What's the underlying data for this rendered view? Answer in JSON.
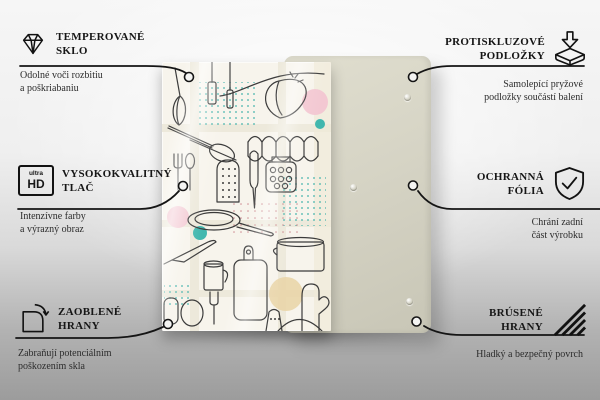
{
  "page": {
    "type": "product-feature-infographic",
    "language": "sk/cz"
  },
  "colors": {
    "background_top": "#f6f6f6",
    "background_bottom": "#9c9c9c",
    "line": "#151515",
    "back_panel": "#d6d4c5",
    "glass_background": "#f7f4ec",
    "art_stroke": "#3b3b3b",
    "art_pink": "#f3c8d2",
    "art_teal": "#49b5ae",
    "art_tan": "#e9d3a6"
  },
  "product": {
    "front_panel": "tempered glass panel printed with kitchen utensil line-art",
    "back_panel": "plain rear panel with round anti-slip pads",
    "visible_pads": 3
  },
  "callouts": {
    "left": [
      {
        "icon": "diamond-icon",
        "title": [
          "TEMPEROVANÉ",
          "SKLO"
        ],
        "subtitle": [
          "Odolné voči rozbitiu",
          "a poškriabaniu"
        ]
      },
      {
        "icon": "ultra-hd-icon",
        "icon_text": {
          "top": "ultra",
          "bottom": "HD"
        },
        "title": [
          "VYSOKOKVALITNÝ",
          "TLAČ"
        ],
        "subtitle": [
          "Intenzívne farby",
          "a výrazný obraz"
        ]
      },
      {
        "icon": "rounded-corner-icon",
        "title": [
          "ZAOBLENÉ",
          "HRANY"
        ],
        "subtitle": [
          "Zabraňují potenciálním",
          "poškozením skla"
        ]
      }
    ],
    "right": [
      {
        "icon": "anti-slip-pad-icon",
        "title": [
          "PROTISKLUZOVÉ",
          "PODLOŽKY"
        ],
        "subtitle": [
          "Samolepící pryžové",
          "podložky součástí balení"
        ]
      },
      {
        "icon": "shield-check-icon",
        "title": [
          "OCHRANNÁ",
          "FÓLIA"
        ],
        "subtitle": [
          "Chrání zadní",
          "část výrobku"
        ]
      },
      {
        "icon": "hatched-edges-icon",
        "title": [
          "BRÚSENÉ",
          "HRANY"
        ],
        "subtitle": [
          "Hladký a bezpečný povrch"
        ]
      }
    ]
  }
}
